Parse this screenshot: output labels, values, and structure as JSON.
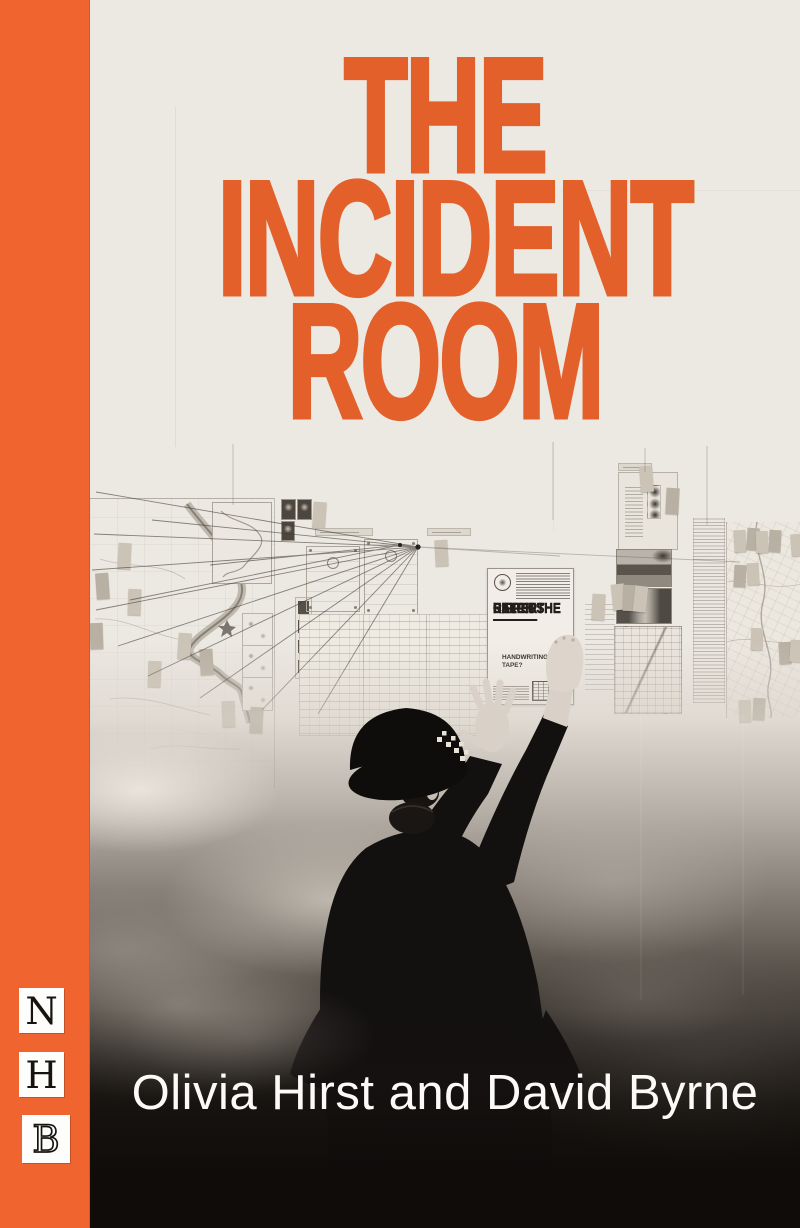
{
  "cover": {
    "title_lines": [
      "THE",
      "INCIDENT",
      "ROOM"
    ],
    "authors": "Olivia Hirst and David Byrne",
    "publisher": {
      "letters": [
        "N",
        "H",
        "B"
      ]
    },
    "board": {
      "poster": {
        "headline": [
          "HELP US",
          "CATCH THE",
          "RIPPER"
        ],
        "bullets": [
          {
            "lead": "HAVE YOU SEEN TH",
            "tail": "HANDWRITING? □"
          },
          {
            "lead": "HAVE YOU HEARD TH",
            "tail": "TAPE?"
          }
        ]
      }
    },
    "colors": {
      "stripe_orange": "#f0642f",
      "title_orange": "#e4602a",
      "background_cream": "#ece8e2",
      "photo_dark": "#131009",
      "author_text": "#fbfaf8"
    }
  }
}
